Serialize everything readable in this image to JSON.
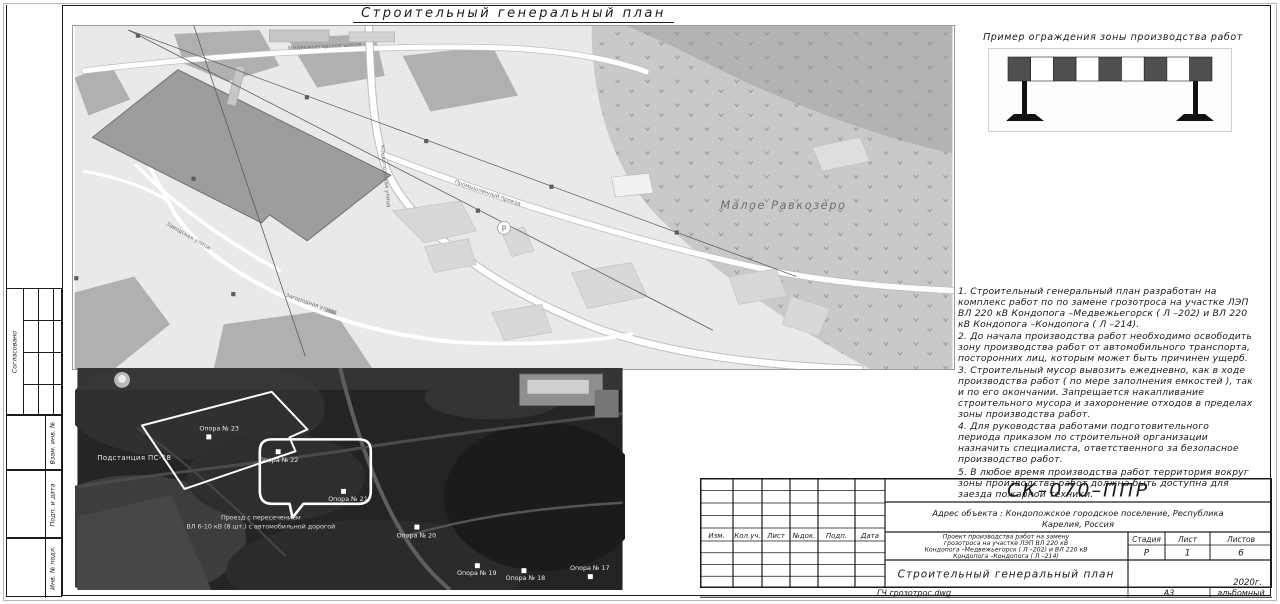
{
  "sheet": {
    "main_title": "Строительный генеральный план"
  },
  "side_stamp": {
    "approved_label": "Согласовано",
    "field_1": "Взам. инв. №",
    "field_2": "Подп. и дата",
    "field_3": "Инв. № подл."
  },
  "fence_example": {
    "caption": "Пример ограждения зоны производства работ"
  },
  "notes": {
    "items": [
      "1.  Строительный генеральный план разработан на комплекс работ по по замене грозотроса на участке ЛЭП ВЛ 220 кВ Кондопога –Медвежьегорск ( Л –202) и ВЛ 220 кВ Кондопога –Кондопога ( Л –214).",
      "2.  До начала производства работ необходимо освободить зону производства работ от автомобильного транспорта, посторонних лиц, которым может быть причинен ущерб.",
      "3.  Строительный мусор вывозить ежедневно, как в ходе производства работ ( по мере заполнения емкостей ), так и по его окончании. Запрещается накапливание строительного мусора и захоронение отходов в пределах зоны производства работ.",
      "4.  Для руководства работами подготовительного периода приказом по строительной организации назначить специалиста, ответственного за безопасное производство работ.",
      "5.  В любое время производства работ территория вокруг зоны производства работ должна быть доступна для заезда пожарной техники."
    ]
  },
  "map": {
    "lake_label": "Малое Равкозеро",
    "street_top": "Медвежьегорское шоссе",
    "street_vertical": "Кондопожская улица",
    "street_diagonal": "Промышленный проезд",
    "street_left": "Заводская улица",
    "street_bottom": "Загородная улица",
    "parking_symbol": "Р"
  },
  "satellite": {
    "substation_label": "Подстанция ПС-18",
    "towers": [
      "Опора № 23",
      "Опора № 22",
      "Опора № 21",
      "Опора № 20",
      "Опора № 19",
      "Опора № 18",
      "Опора № 17"
    ],
    "note_line1": "Проезд с пересечением",
    "note_line2": "ВЛ 6-10 кВ (8 шт.) с автомобильной дорогой"
  },
  "title_block": {
    "doc_code": "СК–070–ППР",
    "address_line1": "Адрес объекта : Кондопожское городское поселение, Республика",
    "address_line2": "Карелия, Россия",
    "revision_columns": [
      "Изм.",
      "Кол.уч.",
      "Лист",
      "№док.",
      "Подп.",
      "Дата"
    ],
    "project_line1": "Проект производства работ на замену",
    "project_line2": "грозотроса на участке ЛЭП ВЛ 220 кВ",
    "project_line3": "Кондопога –Медвежьегорск ( Л –202) и ВЛ 220 кВ",
    "project_line4": "Кондопога –Кондопога ( Л –214)",
    "stage_label": "Стадия",
    "stage_value": "Р",
    "sheet_label": "Лист",
    "sheet_value": "1",
    "sheets_label": "Листов",
    "sheets_value": "6",
    "drawing_title": "Строительный генеральный план",
    "year": "2020г.",
    "footer_file": "ГЧ грозотрос.dwg",
    "footer_format": "А3",
    "footer_orientation": "альбомный"
  }
}
